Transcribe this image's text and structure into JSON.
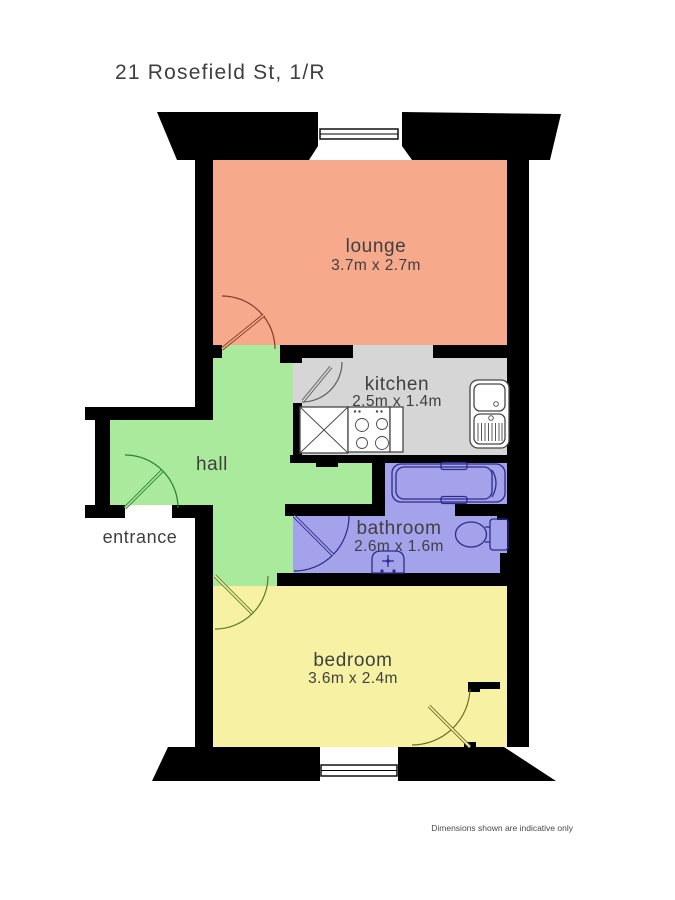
{
  "title": "21 Rosefield St, 1/R",
  "footer": "Dimensions shown are indicative only",
  "wall_color": "#000000",
  "rooms": {
    "lounge": {
      "label": "lounge",
      "dims": "3.7m x 2.7m",
      "color": "#f7a98c"
    },
    "kitchen": {
      "label": "kitchen",
      "dims": "2.5m x 1.4m",
      "color": "#d6d6d6"
    },
    "hall": {
      "label": "hall",
      "color": "#a9ea9c"
    },
    "entrance": {
      "label": "entrance"
    },
    "bathroom": {
      "label": "bathroom",
      "dims": "2.6m x 1.6m",
      "color": "#a4a2ea"
    },
    "bedroom": {
      "label": "bedroom",
      "dims": "3.6m x 2.4m",
      "color": "#f7f2a3"
    }
  },
  "doors": {
    "lounge_color": "#8a3a28",
    "kitchen_color": "#606060",
    "entrance_color": "#2e7d32",
    "bathroom_color": "#2c2c8a",
    "bedroom_color": "#5c7a28",
    "cupboard_color": "#6b6b22"
  },
  "fixtures": {
    "kitchen": [
      "counter-unit",
      "hob",
      "sink"
    ],
    "bathroom": [
      "bathtub",
      "toilet",
      "washbasin"
    ]
  }
}
